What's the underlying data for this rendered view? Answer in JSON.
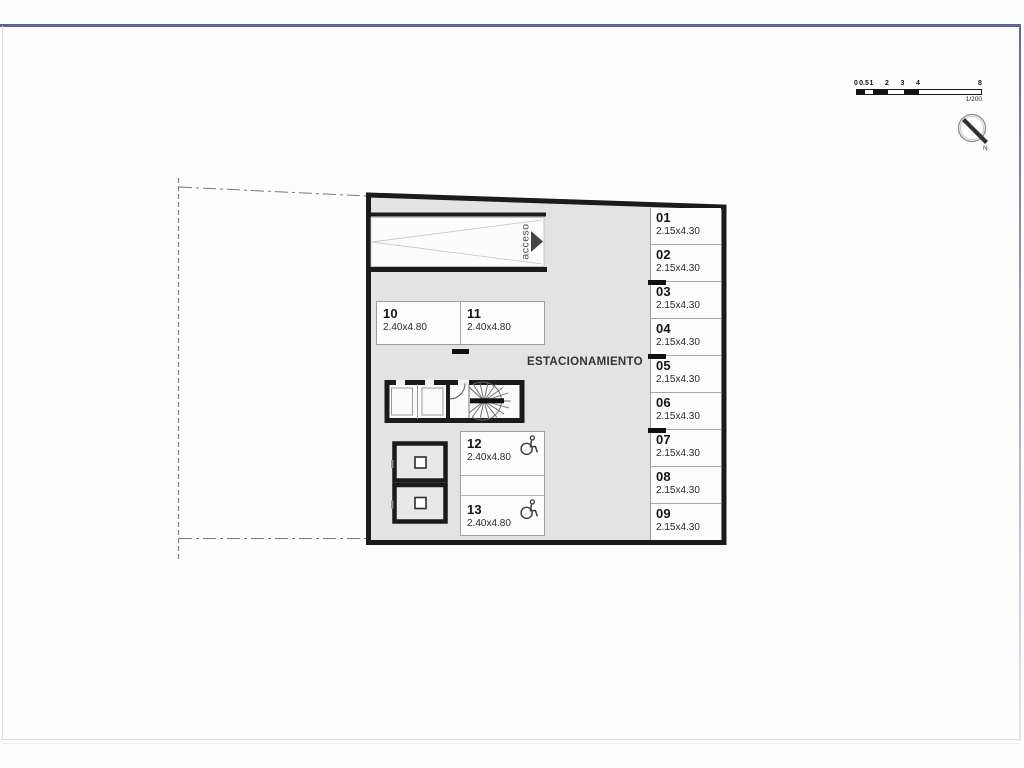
{
  "frame": {
    "top_border_color": "#5f639c"
  },
  "scale_bar": {
    "ticks": [
      "0",
      "0.5",
      "1",
      "2",
      "3",
      "4",
      "8"
    ],
    "ratio": "1/200"
  },
  "north_arrow": {
    "label": "N"
  },
  "floor_plan": {
    "area_label": "ESTACIONAMIENTO",
    "ramp_label": "acceso",
    "colors": {
      "floor": "#e3e3e3",
      "wall": "#1b1b1b",
      "stall_fill": "#fdfdfd"
    },
    "stalls": {
      "right_column": [
        {
          "id": "01",
          "dims": "2.15x4.30"
        },
        {
          "id": "02",
          "dims": "2.15x4.30"
        },
        {
          "id": "03",
          "dims": "2.15x4.30"
        },
        {
          "id": "04",
          "dims": "2.15x4.30"
        },
        {
          "id": "05",
          "dims": "2.15x4.30"
        },
        {
          "id": "06",
          "dims": "2.15x4.30"
        },
        {
          "id": "07",
          "dims": "2.15x4.30"
        },
        {
          "id": "08",
          "dims": "2.15x4.30"
        },
        {
          "id": "09",
          "dims": "2.15x4.30"
        }
      ],
      "middle_row": [
        {
          "id": "10",
          "dims": "2.40x4.80"
        },
        {
          "id": "11",
          "dims": "2.40x4.80"
        }
      ],
      "accessible": [
        {
          "id": "12",
          "dims": "2.40x4.80"
        },
        {
          "id": "13",
          "dims": "2.40x4.80"
        }
      ]
    }
  }
}
